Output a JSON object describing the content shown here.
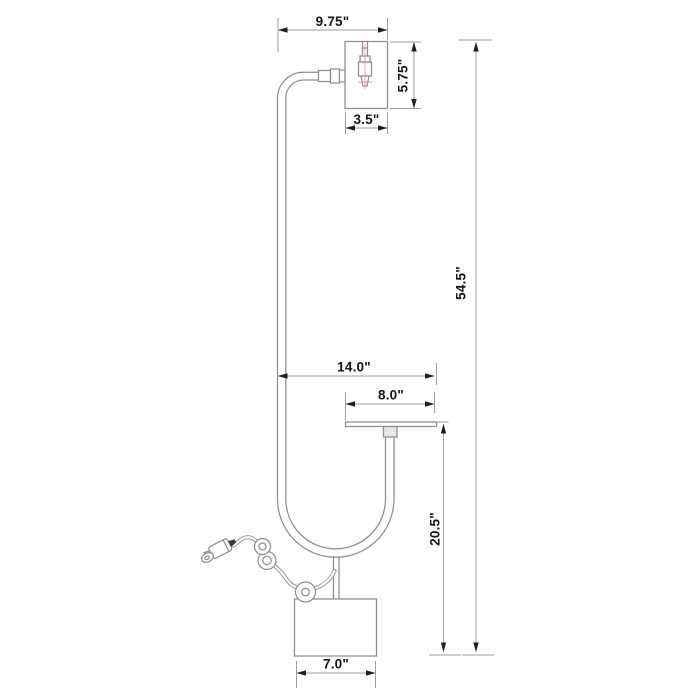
{
  "page": {
    "background": "#ffffff",
    "content_type": "product dimension line drawing of a floor lamp with tray table"
  },
  "diagram": {
    "units": "inches",
    "style": {
      "art_line_color": "#8e8e8e",
      "dimension_line_color": "#9e9e9e",
      "arrow_color": "#1f1f1f",
      "text_color": "#141414",
      "socket_centerline_color": "#d9908f"
    },
    "dimensions": {
      "head_offset_width": {
        "label": "9.75\""
      },
      "shade_height": {
        "label": "5.75\""
      },
      "shade_width": {
        "label": "3.5\""
      },
      "overall_height": {
        "label": "54.5\""
      },
      "tray_reach": {
        "label": "14.0\""
      },
      "tray_width": {
        "label": "8.0\""
      },
      "tray_floor_height": {
        "label": "20.5\""
      },
      "base_width": {
        "label": "7.0\""
      }
    }
  }
}
